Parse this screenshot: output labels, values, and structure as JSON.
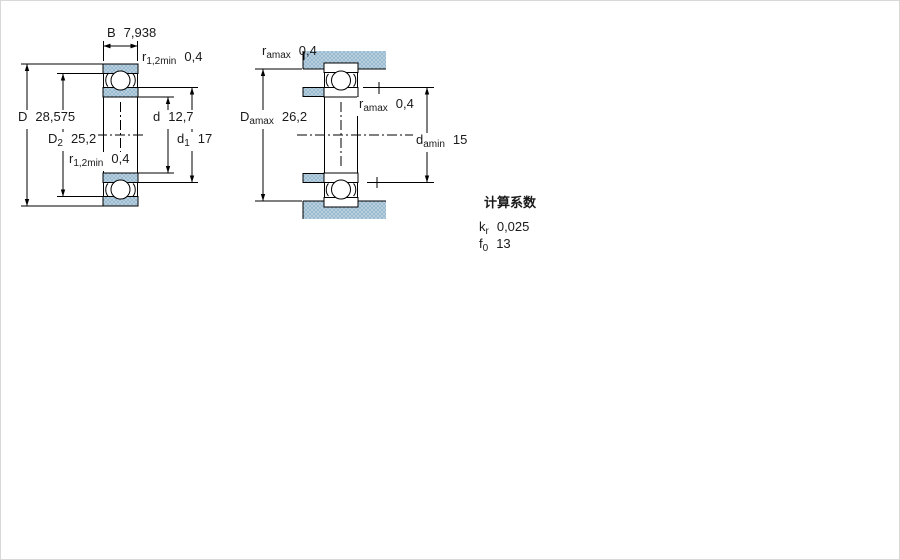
{
  "drawing": {
    "left_view": {
      "description": "bearing cross-section with boundary dimensions",
      "dims": {
        "B": {
          "sym": "B",
          "sub": "",
          "val": "7,938"
        },
        "r12_top": {
          "sym": "r",
          "sub": "1,2min",
          "val": "0,4"
        },
        "D": {
          "sym": "D",
          "sub": "",
          "val": "28,575"
        },
        "D2": {
          "sym": "D",
          "sub": "2",
          "val": "25,2"
        },
        "d": {
          "sym": "d",
          "sub": "",
          "val": "12,7"
        },
        "d1": {
          "sym": "d",
          "sub": "1",
          "val": "17"
        },
        "r12_bot": {
          "sym": "r",
          "sub": "1,2min",
          "val": "0,4"
        }
      }
    },
    "right_view": {
      "description": "mounted bearing abutment dimensions",
      "dims": {
        "ra_top": {
          "sym": "r",
          "sub": "amax",
          "val": "0,4"
        },
        "Da_max": {
          "sym": "D",
          "sub": "amax",
          "val": "26,2"
        },
        "ra_mid": {
          "sym": "r",
          "sub": "amax",
          "val": "0,4"
        },
        "da_min": {
          "sym": "d",
          "sub": "amin",
          "val": "15"
        }
      }
    },
    "calculation_factors": {
      "title": "计算系数",
      "rows": [
        {
          "sym": "k",
          "sub": "r",
          "val": "0,025"
        },
        {
          "sym": "f",
          "sub": "0",
          "val": "13"
        }
      ]
    },
    "colors": {
      "steel_fill": "#b7cfdf",
      "steel_dot": "#86abc6",
      "line": "#000000"
    }
  }
}
